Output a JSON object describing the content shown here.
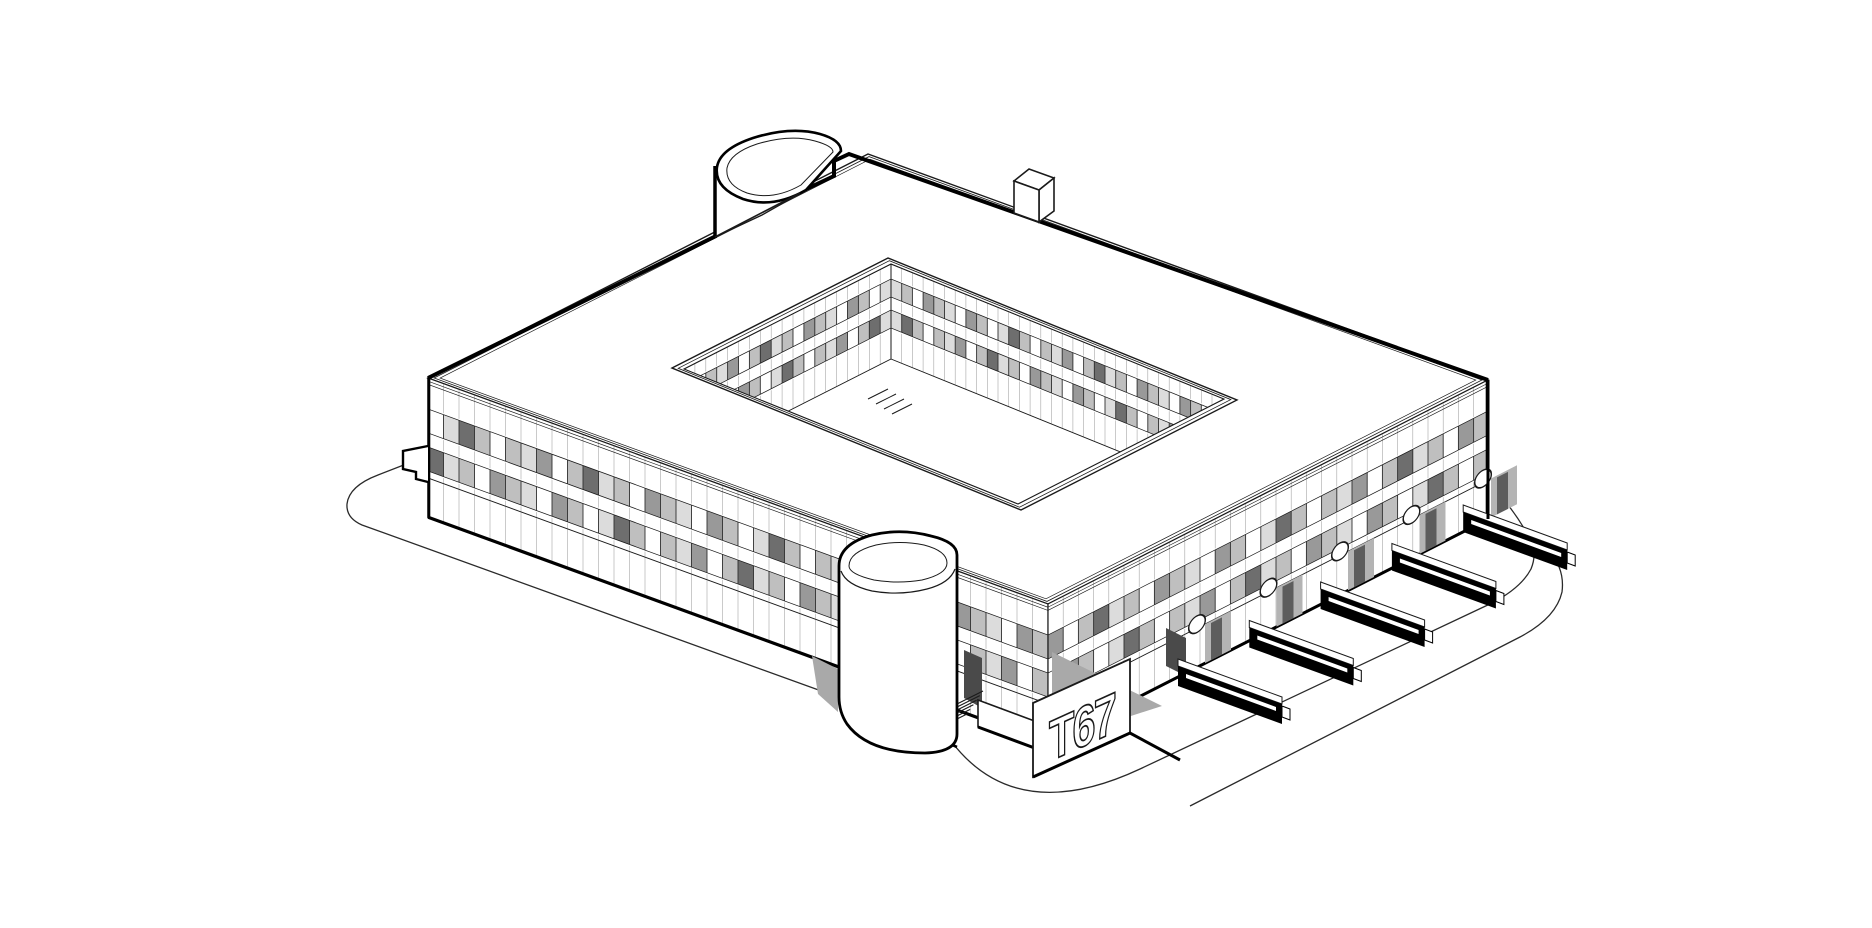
{
  "sign": {
    "text": "T67"
  },
  "palette": {
    "background": "#ffffff",
    "line": "#1a1a1a",
    "heavy": "#000000",
    "shadow": "#a9a9a9",
    "dark_opening": "#4a4a4a",
    "joint": "#a6a6a6",
    "mullion": "#2f2f2f",
    "glazing": [
      "#ffffff",
      "#dcdcdc",
      "#bfbfbf",
      "#999999",
      "#6e6e6e"
    ]
  },
  "glazing_pattern": [
    2,
    1,
    0,
    3,
    2,
    0,
    1,
    4,
    2,
    0,
    2,
    1,
    3,
    0,
    2,
    4,
    1,
    2,
    0,
    3
  ],
  "building": {
    "window_bands_per_facade": 2,
    "courtyard_window_bands": 2,
    "ground_floor": true,
    "loading_dock_count": 5,
    "porthole_count": 5,
    "stair_tower_count": 2,
    "roof_vent_count": 1
  }
}
